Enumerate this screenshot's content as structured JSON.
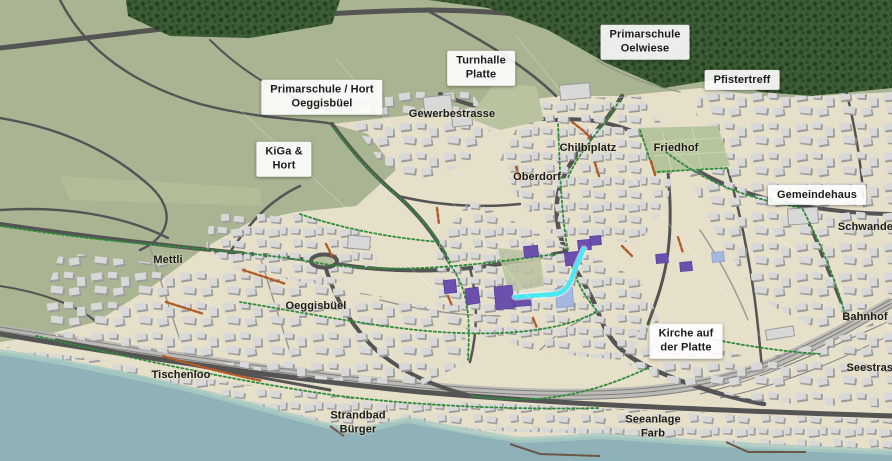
{
  "map": {
    "type": "3d-town-map",
    "labels": [
      {
        "id": "primarschule-oelwiese",
        "text": "Primarschule\nOelwiese",
        "x": 645,
        "y": 42,
        "boxed": true
      },
      {
        "id": "turnhalle-platte",
        "text": "Turnhalle\nPlatte",
        "x": 481,
        "y": 68,
        "boxed": true
      },
      {
        "id": "pfistertreff",
        "text": "Pfistertreff",
        "x": 742,
        "y": 80,
        "boxed": true
      },
      {
        "id": "primarschule-hort-oeggisbuel",
        "text": "Primarschule / Hort\nOeggisbüel",
        "x": 322,
        "y": 97,
        "boxed": true
      },
      {
        "id": "kiga-hort",
        "text": "KiGa &\nHort",
        "x": 284,
        "y": 159,
        "boxed": true
      },
      {
        "id": "gemeindehaus",
        "text": "Gemeindehaus",
        "x": 817,
        "y": 195,
        "boxed": true
      },
      {
        "id": "kirche-auf-der-platte",
        "text": "Kirche auf\nder Platte",
        "x": 686,
        "y": 341,
        "boxed": true
      },
      {
        "id": "gewerbestrasse",
        "text": "Gewerbestrasse",
        "x": 452,
        "y": 114,
        "boxed": false
      },
      {
        "id": "chilbiplatz",
        "text": "Chilbiplatz",
        "x": 588,
        "y": 148,
        "boxed": false
      },
      {
        "id": "friedhof",
        "text": "Friedhof",
        "x": 676,
        "y": 148,
        "boxed": false
      },
      {
        "id": "oberdorf",
        "text": "Oberdorf",
        "x": 537,
        "y": 177,
        "boxed": false
      },
      {
        "id": "schwandel",
        "text": "Schwandel",
        "x": 867,
        "y": 227,
        "boxed": false
      },
      {
        "id": "mettli",
        "text": "Mettli",
        "x": 168,
        "y": 260,
        "boxed": false
      },
      {
        "id": "oeggisbuel",
        "text": "Oeggisbüel",
        "x": 316,
        "y": 306,
        "boxed": false
      },
      {
        "id": "bahnhof",
        "text": "Bahnhof",
        "x": 865,
        "y": 317,
        "boxed": false
      },
      {
        "id": "seestrasse",
        "text": "Seestrasse",
        "x": 876,
        "y": 368,
        "boxed": false
      },
      {
        "id": "tischenloo",
        "text": "Tischenloo",
        "x": 181,
        "y": 375,
        "boxed": false
      },
      {
        "id": "strandbad-buerger",
        "text": "Strandbad\nBürger",
        "x": 358,
        "y": 423,
        "boxed": false
      },
      {
        "id": "seeanlage-farb",
        "text": "Seeanlage\nFarb",
        "x": 653,
        "y": 427,
        "boxed": false
      }
    ],
    "colors": {
      "ground": "#e6dfc9",
      "field": "#a9b492",
      "fieldLight": "#b9c3a0",
      "friedhof": "#b6c59d",
      "forest": "#3e5c38",
      "treeDark": "#26411f",
      "treeMid": "#2f4e27",
      "lake": "#8fb2b9",
      "lakeShore": "#a9cac3",
      "road": "#545454",
      "roadMinor": "#979792",
      "rail": "#7d7d7d",
      "railBase": "#b5b5b2",
      "building": "#d8d8d8",
      "buildingShadow": "#9b9b9b",
      "pathGreen": "#2e8b3a",
      "segOrange": "#b15b28",
      "purple": "#6c50ae",
      "lavender": "#a4b8de",
      "cyan": "#4ae8f2",
      "labelText": "#1b1b1b",
      "labelBg": "rgba(255,255,255,0.9)"
    }
  }
}
